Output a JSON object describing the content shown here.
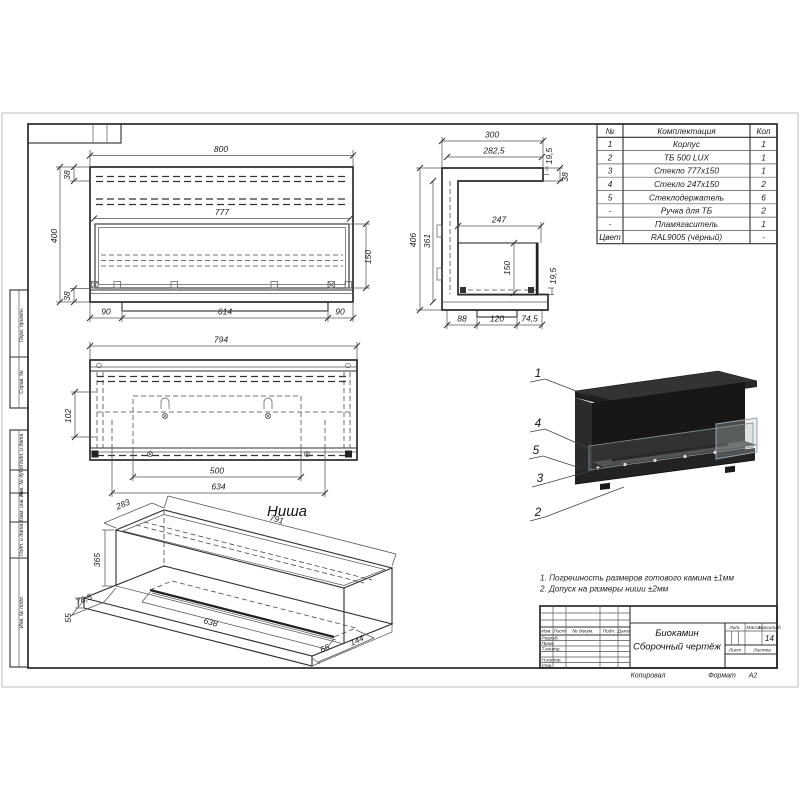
{
  "sheet": {
    "parts_table": {
      "headers": {
        "num": "№",
        "name": "Комплектация",
        "qty": "Кол"
      },
      "rows": [
        {
          "num": "1",
          "name": "Корпус",
          "qty": "1"
        },
        {
          "num": "2",
          "name": "ТБ 500 LUX",
          "qty": "1"
        },
        {
          "num": "3",
          "name": "Стекло 777х150",
          "qty": "1"
        },
        {
          "num": "4",
          "name": "Стекло 247х150",
          "qty": "2"
        },
        {
          "num": "5",
          "name": "Стеклодержатель",
          "qty": "6"
        },
        {
          "num": "-",
          "name": "Ручка для ТБ",
          "qty": "2"
        },
        {
          "num": "-",
          "name": "Пламягаситель",
          "qty": "1"
        },
        {
          "num": "Цвет",
          "name": "RAL9005 (чёрный)",
          "qty": "-"
        }
      ]
    },
    "front_view": {
      "width": "800",
      "opening_width": "777",
      "height": "400",
      "glass_height": "150",
      "top_inset": "38",
      "bottom_inset": "38",
      "left_margin": "90",
      "base_width": "614",
      "right_margin": "90"
    },
    "side_view": {
      "depth": "300",
      "inner_depth": "282,5",
      "top_gap": "19,5",
      "top_thickness": "38",
      "glass_width": "247",
      "height": "406",
      "inner_height": "361",
      "glass_height": "150",
      "bottom_gap": "19,5",
      "seg1": "88",
      "seg2": "120",
      "seg3": "74,5"
    },
    "niche_front": {
      "width": "794",
      "bracket_offset": "102",
      "slot_width": "500",
      "slot_outer": "634",
      "caption": "Ниша"
    },
    "niche_iso": {
      "depth": "283",
      "length": "791",
      "height": "365",
      "ledge": "76,5",
      "base": "55",
      "slot_length": "638",
      "edge_offset": "65",
      "slot_width": "144"
    },
    "callouts": {
      "c1": "1",
      "c2": "2",
      "c3": "3",
      "c4": "4",
      "c5": "5"
    },
    "notes": {
      "line1": "1. Погрешность размеров готового камина ±1мм",
      "line2": "2. Допуск на размеры ниши ±2мм"
    },
    "title_block": {
      "header_cols": {
        "izm": "Изм.",
        "list": "Лист",
        "dokum": "№ докум.",
        "podp": "Подп.",
        "data": "Дата"
      },
      "rows": {
        "razrab": "Разраб.",
        "prov": "Пров.",
        "tkontr": "Т.контр.",
        "nkontr": "Н.контр.",
        "utv": "Утв."
      },
      "doc_name": "Биокамин",
      "doc_type": "Сборочный чертёж",
      "lit": "Лит.",
      "mass": "Масса",
      "scale": "Масштаб",
      "scale_value": "14",
      "sheet_label": "Лист",
      "sheets_label": "Листов",
      "copied": "Копировал",
      "format_label": "Формат",
      "format_value": "А2"
    },
    "margin": {
      "m1": "Перв. примен.",
      "m2": "Справ. №",
      "m3": "Подп. и дата",
      "m4": "Инв. № дубл.",
      "m5": "Взам. инв. №",
      "m6": "Подп. и дата",
      "m7": "Инв. № подл."
    }
  }
}
